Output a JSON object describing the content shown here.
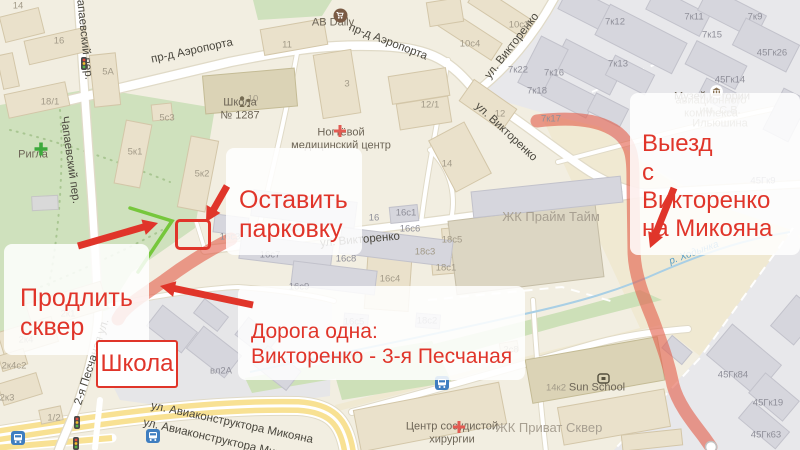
{
  "notes": {
    "keep_parking": "Оставить\nпарковку",
    "extend_park": "Продлить\nсквер",
    "one_road": "Дорога одна:\nВикторенко - 3-я Песчаная",
    "school": "Школа",
    "exit": "Выезд\nс Викторенко\nна Микояна"
  },
  "colors": {
    "annotation_red": "#e0352a",
    "route_highlight": "#e3614d",
    "park_edge_line": "#76c73c",
    "park_green": "#cfe1bd",
    "water_blue": "#a9cfe5",
    "bus_icon_blue": "#3f7ec0",
    "yellow_road": "#f8e193"
  },
  "icons": {
    "cart_icon": "shopping-cart in brown circle",
    "school_icon": "adult-and-child figures",
    "pharmacy_plus_icon": "green plus",
    "medical_cross_icon": "red plus",
    "museum_icon": "classical building",
    "sun_school_icon": "rounded square",
    "bus_stop_icon": "white bus on blue square",
    "traffic_light_icon": "red-yellow-green lights",
    "route_end_marker": "white circle"
  },
  "street_labels": [
    {
      "text": "пр-д Аэропорта",
      "x": 192,
      "y": 51,
      "rot": -12
    },
    {
      "text": "пр-д Аэропорта",
      "x": 388,
      "y": 42,
      "rot": 21
    },
    {
      "text": "ул. Викторенко",
      "x": 512,
      "y": 46,
      "rot": -52
    },
    {
      "text": "ул. Викторенко",
      "x": 506,
      "y": 132,
      "rot": 43
    },
    {
      "text": "ул. Викторенко",
      "x": 360,
      "y": 240,
      "rot": -5
    },
    {
      "text": "Чапаевский пер.",
      "x": 84,
      "y": 36,
      "rot": 84
    },
    {
      "text": "Чапаевский пер.",
      "x": 70,
      "y": 160,
      "rot": 82
    },
    {
      "text": "2-я Песчаная ул.",
      "x": 92,
      "y": 362,
      "rot": -72
    },
    {
      "text": "ул. Авиаконструктора Микояна",
      "x": 232,
      "y": 423,
      "rot": 12
    },
    {
      "text": "ул. Авиаконструктора Микояна",
      "x": 224,
      "y": 441,
      "rot": 13
    }
  ],
  "water_labels": [
    {
      "text": "р. Ходынка",
      "x": 333,
      "y": 357,
      "rot": -10
    },
    {
      "text": "р. Ходынка",
      "x": 694,
      "y": 253,
      "rot": -20
    }
  ],
  "poi_labels": [
    {
      "text": "AB Daily",
      "x": 333,
      "y": 23
    },
    {
      "text": "Школа\n№ 1287",
      "x": 240,
      "y": 110
    },
    {
      "text": "Ногтёвой\nмедицинский центр",
      "x": 341,
      "y": 140
    },
    {
      "text": "Ригла",
      "x": 33,
      "y": 155
    },
    {
      "text": "Музей истории",
      "x": 712,
      "y": 97
    },
    {
      "text": "авиационного комплекса",
      "x": 711,
      "y": 108,
      "color": "#938b7c"
    },
    {
      "text": "им. С.В. Ильюшина",
      "x": 720,
      "y": 118,
      "color": "#938b7c"
    },
    {
      "text": "ЖК Прайм Тайм",
      "x": 551,
      "y": 217,
      "size": 13,
      "color": "#a8a092"
    },
    {
      "text": "ЖК Приват Сквер",
      "x": 549,
      "y": 428,
      "size": 13,
      "color": "#a8a092"
    },
    {
      "text": "Sun School",
      "x": 597,
      "y": 388
    },
    {
      "text": "Центр сосудистой\nхирургии",
      "x": 452,
      "y": 434
    }
  ],
  "building_labels": [
    {
      "text": "14",
      "x": 18,
      "y": 6
    },
    {
      "text": "16",
      "x": 59,
      "y": 41
    },
    {
      "text": "18/1",
      "x": 50,
      "y": 102
    },
    {
      "text": "5А",
      "x": 108,
      "y": 72
    },
    {
      "text": "5с3",
      "x": 167,
      "y": 118
    },
    {
      "text": "10",
      "x": 253,
      "y": 99
    },
    {
      "text": "5к1",
      "x": 135,
      "y": 152
    },
    {
      "text": "5к2",
      "x": 202,
      "y": 174
    },
    {
      "text": "11",
      "x": 287,
      "y": 45
    },
    {
      "text": "3",
      "x": 347,
      "y": 84
    },
    {
      "text": "12/1",
      "x": 430,
      "y": 105
    },
    {
      "text": "12",
      "x": 500,
      "y": 114
    },
    {
      "text": "10с3",
      "x": 519,
      "y": 25
    },
    {
      "text": "10с4",
      "x": 470,
      "y": 44
    },
    {
      "text": "7к22",
      "x": 518,
      "y": 70,
      "color": "#8f8f99"
    },
    {
      "text": "7к16",
      "x": 554,
      "y": 73,
      "color": "#8f8f99"
    },
    {
      "text": "7к18",
      "x": 537,
      "y": 91,
      "color": "#8f8f99"
    },
    {
      "text": "7к17",
      "x": 551,
      "y": 119,
      "color": "#8f8f99"
    },
    {
      "text": "7к12",
      "x": 615,
      "y": 22,
      "color": "#8f8f99"
    },
    {
      "text": "7к13",
      "x": 618,
      "y": 64,
      "color": "#8f8f99"
    },
    {
      "text": "7к11",
      "x": 694,
      "y": 17,
      "color": "#8f8f99"
    },
    {
      "text": "7к9",
      "x": 755,
      "y": 17,
      "color": "#8f8f99"
    },
    {
      "text": "7к15",
      "x": 712,
      "y": 35,
      "color": "#8f8f99"
    },
    {
      "text": "45Гк26",
      "x": 772,
      "y": 53,
      "color": "#8f8f99"
    },
    {
      "text": "45Гк14",
      "x": 730,
      "y": 80,
      "color": "#8f8f99"
    },
    {
      "text": "45Гк9",
      "x": 763,
      "y": 181,
      "color": "#8f8f99"
    },
    {
      "text": "16с2",
      "x": 294,
      "y": 228,
      "color": "#8f8f99"
    },
    {
      "text": "16с3",
      "x": 230,
      "y": 237,
      "color": "#8f8f99"
    },
    {
      "text": "16",
      "x": 374,
      "y": 218,
      "color": "#8f8f99"
    },
    {
      "text": "16с1",
      "x": 406,
      "y": 213,
      "color": "#8f8f99"
    },
    {
      "text": "16с6",
      "x": 410,
      "y": 229,
      "color": "#8f8f99"
    },
    {
      "text": "16с7",
      "x": 270,
      "y": 255,
      "color": "#8f8f99"
    },
    {
      "text": "16с8",
      "x": 346,
      "y": 259,
      "color": "#8f8f99"
    },
    {
      "text": "16с9",
      "x": 299,
      "y": 287,
      "color": "#8f8f99"
    },
    {
      "text": "16с4",
      "x": 390,
      "y": 279
    },
    {
      "text": "16с5",
      "x": 354,
      "y": 322,
      "color": "#8f8f99"
    },
    {
      "text": "18с2",
      "x": 427,
      "y": 321,
      "color": "#8f8f99"
    },
    {
      "text": "18с3",
      "x": 425,
      "y": 252
    },
    {
      "text": "18с1",
      "x": 446,
      "y": 268
    },
    {
      "text": "18с5",
      "x": 452,
      "y": 240
    },
    {
      "text": "14",
      "x": 447,
      "y": 164
    },
    {
      "text": "2с8",
      "x": 511,
      "y": 350
    },
    {
      "text": "14к2",
      "x": 556,
      "y": 388
    },
    {
      "text": "45Гк84",
      "x": 733,
      "y": 375,
      "color": "#8f8f99"
    },
    {
      "text": "45Гк19",
      "x": 768,
      "y": 403,
      "color": "#8f8f99"
    },
    {
      "text": "45Гк63",
      "x": 766,
      "y": 435,
      "color": "#8f8f99"
    },
    {
      "text": "вл2А",
      "x": 221,
      "y": 371,
      "color": "#8f8f99"
    },
    {
      "text": "2к1",
      "x": 68,
      "y": 314
    },
    {
      "text": "2к4",
      "x": 26,
      "y": 340
    },
    {
      "text": "2к4с2",
      "x": 14,
      "y": 366
    },
    {
      "text": "2к3",
      "x": 7,
      "y": 398
    },
    {
      "text": "1/2",
      "x": 54,
      "y": 418
    }
  ]
}
